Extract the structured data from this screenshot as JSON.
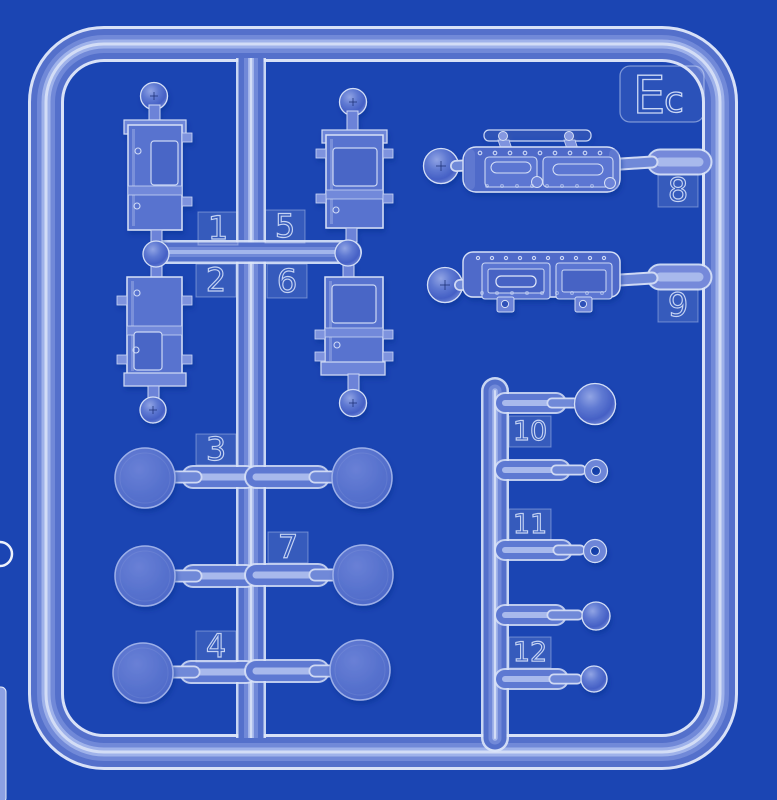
{
  "colors": {
    "background": "#1b45b3",
    "plastic_body": "#5470cb",
    "plastic_mid": "#7189d8",
    "plastic_highlight": "#a3b5eb",
    "plastic_edge": "#e3eafb"
  },
  "sprue": {
    "marking": {
      "full": "Ec",
      "large": "E",
      "small": "c"
    },
    "tags": [
      "1",
      "2",
      "3",
      "4",
      "5",
      "6",
      "7",
      "8",
      "9",
      "10",
      "11",
      "12"
    ]
  }
}
